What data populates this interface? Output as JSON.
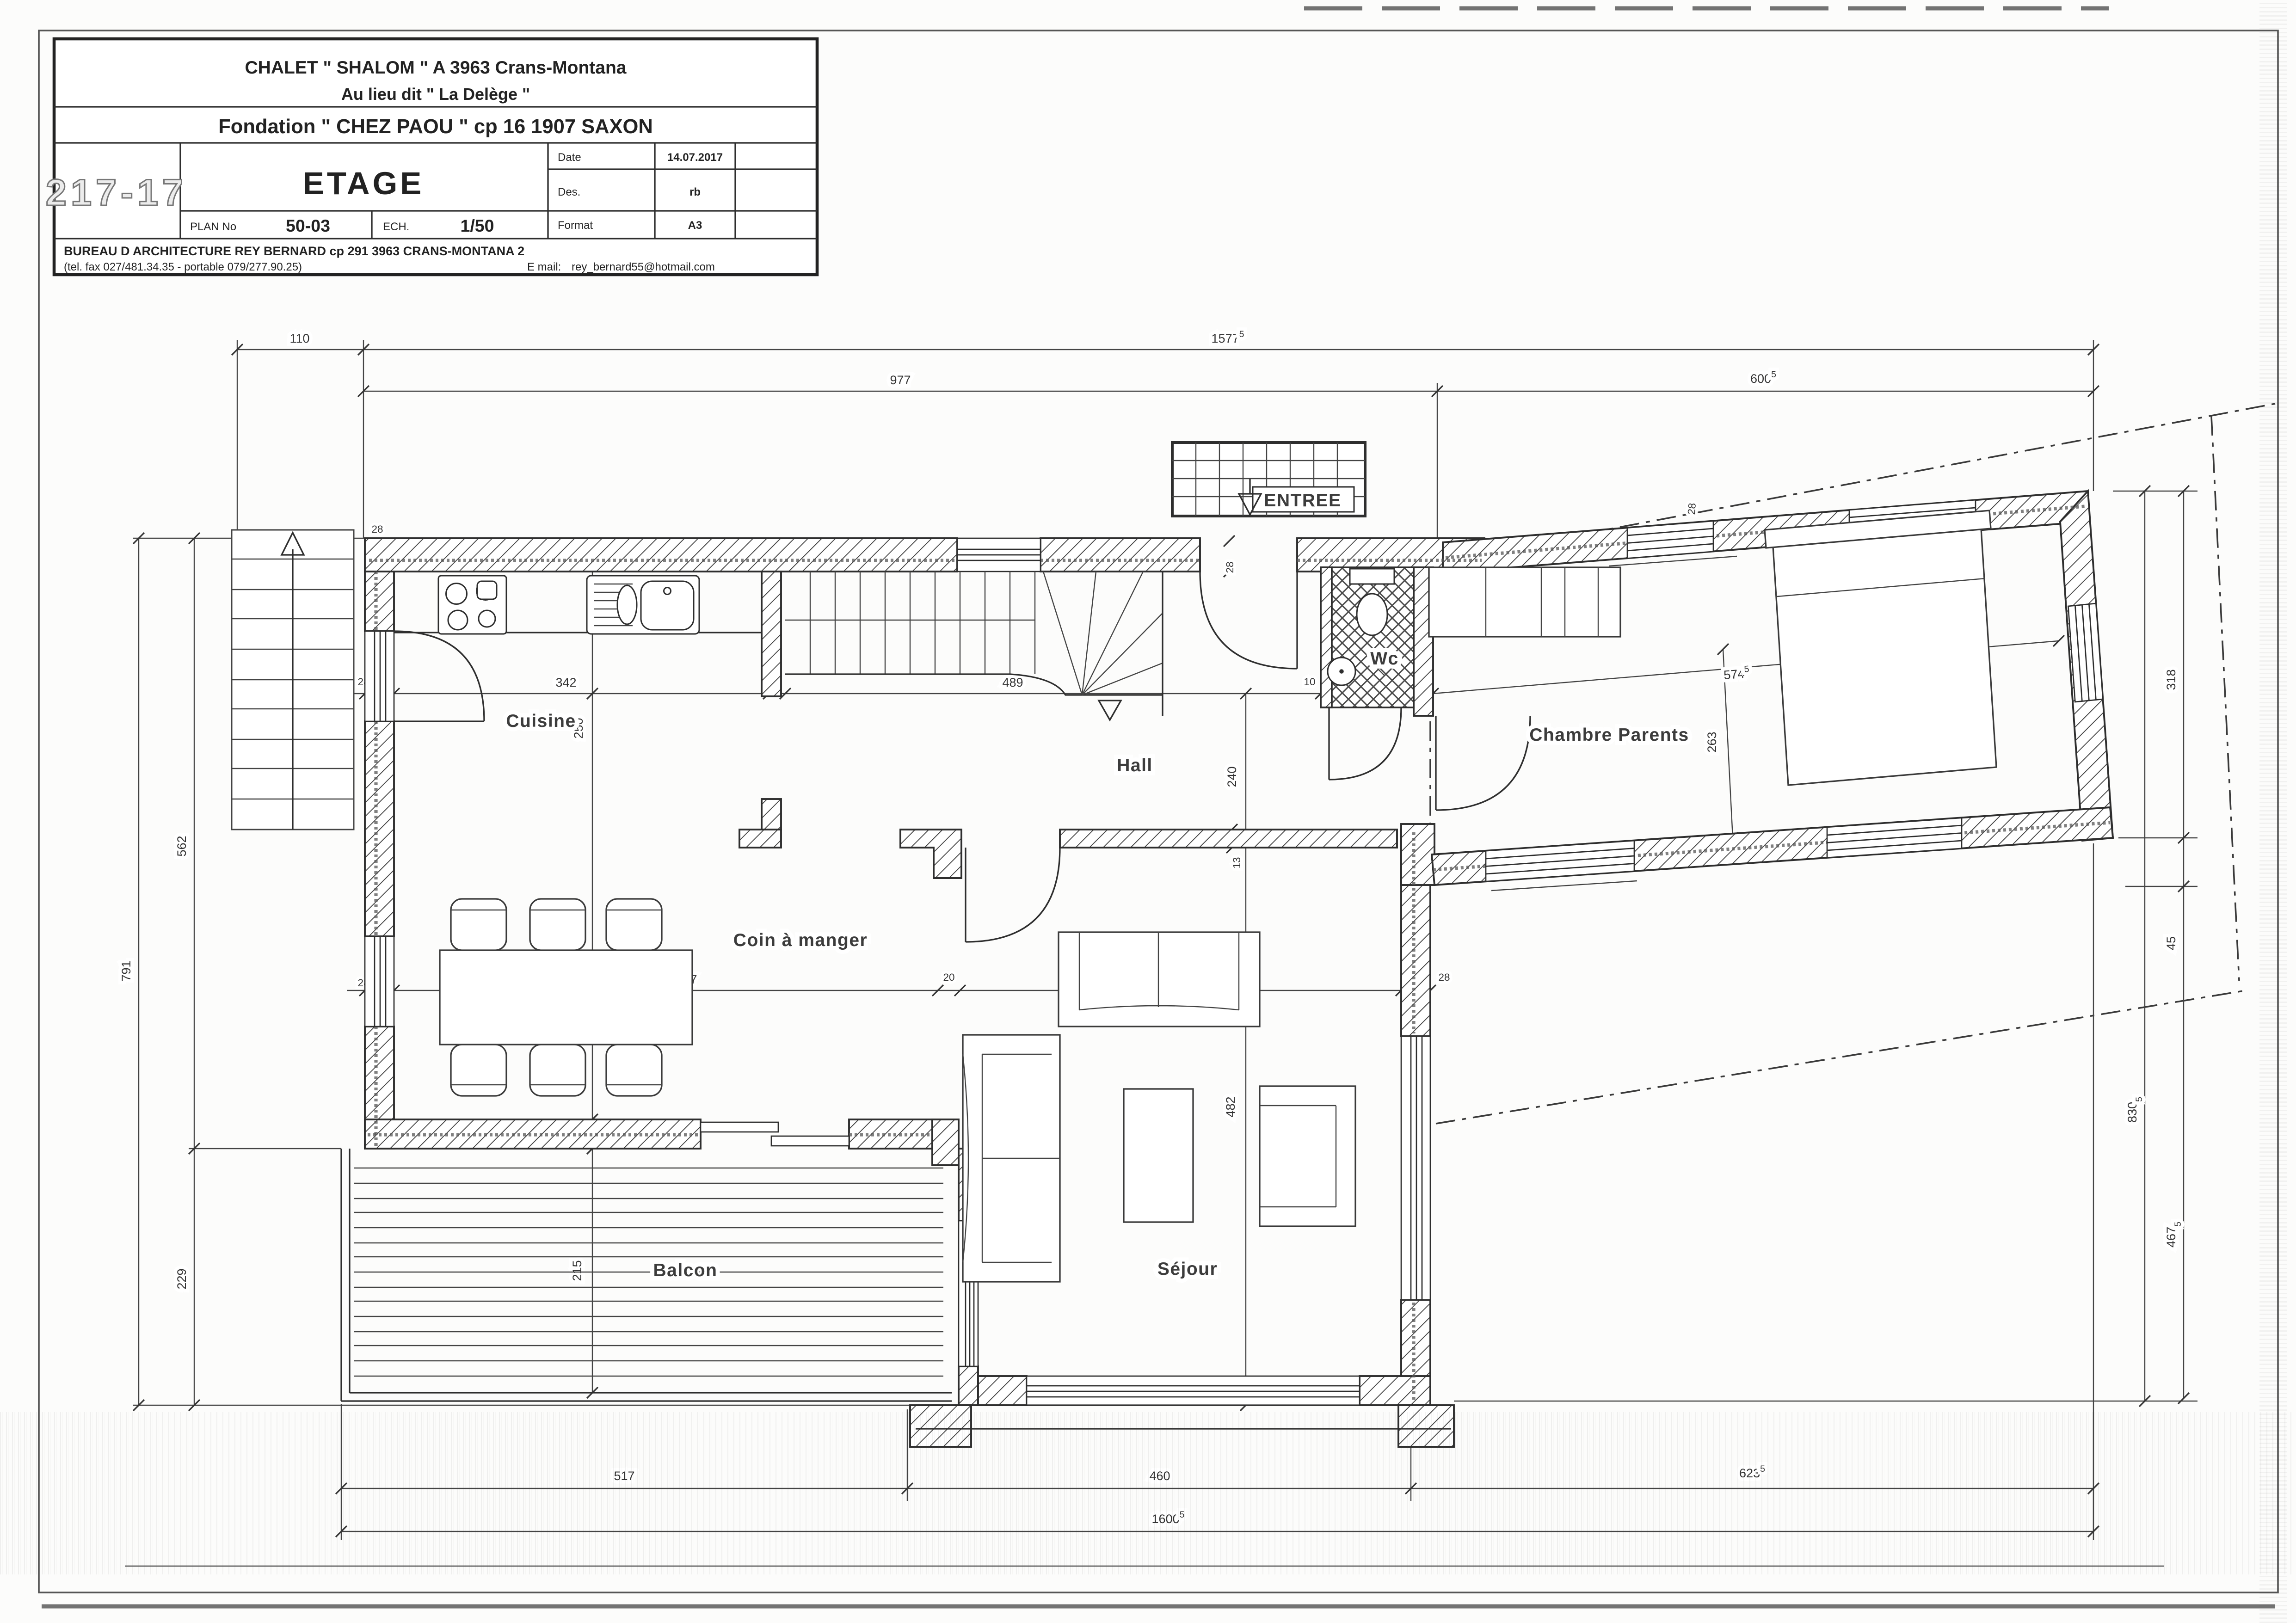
{
  "sheet": {
    "background": "#fcfcfb",
    "ink": "#2e2e2e",
    "light_ink": "#555"
  },
  "title_block": {
    "line1": "CHALET  \" SHALOM \"  A 3963  Crans-Montana",
    "line2": "Au lieu dit   \" La Delège \"",
    "line3": "Fondation  \" CHEZ PAOU \"  cp 16  1907  SAXON",
    "doc_number": "217-17",
    "sheet_name": "ETAGE",
    "plan_no_label": "PLAN No",
    "plan_no": "50-03",
    "scale_label": "ECH.",
    "scale": "1/50",
    "date_label": "Date",
    "date": "14.07.2017",
    "des_label": "Des.",
    "des": "rb",
    "format_label": "Format",
    "format": "A3",
    "office_line": "BUREAU D ARCHITECTURE REY BERNARD   cp  291 3963 CRANS-MONTANA 2",
    "phone_line": "(tel. fax 027/481.34.35 - portable 079/277.90.25)",
    "email_label": "E mail:",
    "email": "rey_bernard55@hotmail.com"
  },
  "rooms": {
    "entree": "ENTREE",
    "cuisine": "Cuisine",
    "hall": "Hall",
    "wc": "Wc",
    "chambre": "Chambre Parents",
    "coin": "Coin à manger",
    "sejour": "Séjour",
    "balcon": "Balcon"
  },
  "dims": {
    "t110": "110",
    "t1577": {
      "m": "1577",
      "s": "5"
    },
    "t977": "977",
    "t600": {
      "m": "600",
      "s": "5"
    },
    "l791": "791",
    "l562": "562",
    "l229": "229",
    "lw1": "28",
    "lw2": "28",
    "tl28": "28",
    "r318": "318",
    "r45": "45",
    "r467": {
      "m": "467",
      "s": "5"
    },
    "r830": {
      "m": "830",
      "s": "5"
    },
    "b517": "517",
    "b460": "460",
    "b623": {
      "m": "623",
      "s": "5"
    },
    "b1600": {
      "m": "1600",
      "s": "5"
    },
    "c28": "28",
    "c342": "342",
    "c15": "15",
    "c489": "489",
    "c10": "10",
    "c75": "75",
    "c18": "18",
    "c574": {
      "m": "574",
      "s": "5"
    },
    "c263": "263",
    "e28": "28",
    "e251": "251",
    "e497": "497",
    "e20": "20",
    "e404": "404",
    "e482": "482",
    "e28r": "28",
    "m240": "240",
    "m250": "250",
    "m13": "13",
    "m28door": "28",
    "m28wing": "28",
    "m25": "25",
    "m215": "215"
  }
}
